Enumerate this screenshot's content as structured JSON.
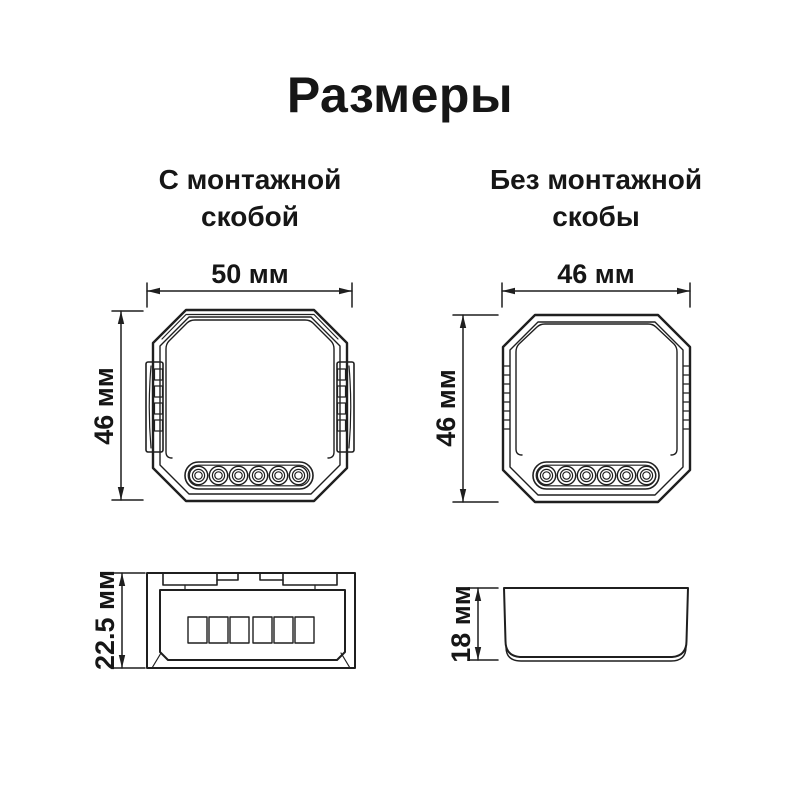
{
  "title": "Размеры",
  "left_column": {
    "heading_line1": "С монтажной",
    "heading_line2": "скобой",
    "dims": {
      "width": "50 мм",
      "height": "46 мм",
      "depth": "22.5 мм"
    }
  },
  "right_column": {
    "heading_line1": "Без монтажной",
    "heading_line2": "скобы",
    "dims": {
      "width": "46 мм",
      "height": "46 мм",
      "depth": "18 мм"
    }
  },
  "colors": {
    "line": "#1f1f1f",
    "text": "#161616",
    "background": "#ffffff"
  }
}
